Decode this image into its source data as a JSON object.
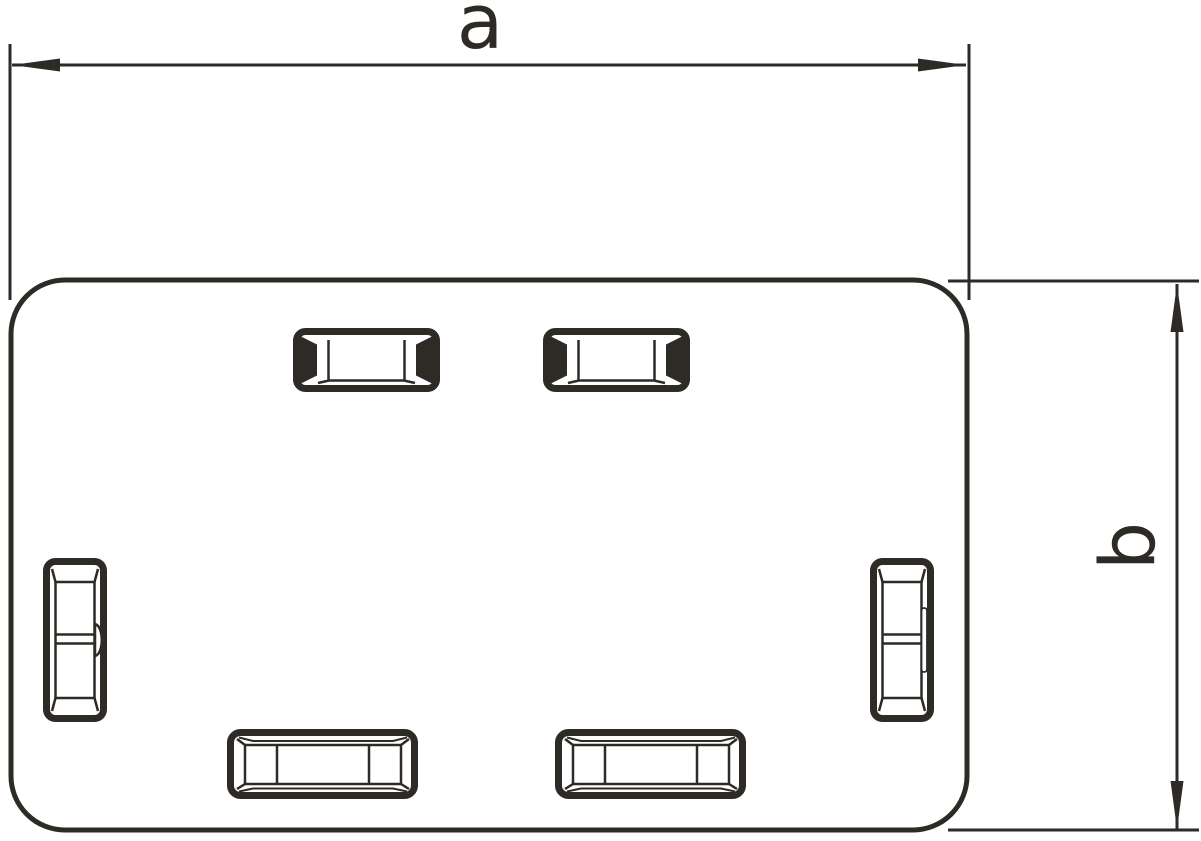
{
  "drawing": {
    "type": "dimensioned technical drawing of rounded rectangular end-piece with latch slots",
    "dim_width": {
      "label": "a"
    },
    "dim_height": {
      "label": "b"
    },
    "line_color": "#2E2A26",
    "background_color": "#FFFFFF",
    "slot_counts": {
      "top": 2,
      "bottom": 2,
      "left": 1,
      "right": 1
    }
  }
}
